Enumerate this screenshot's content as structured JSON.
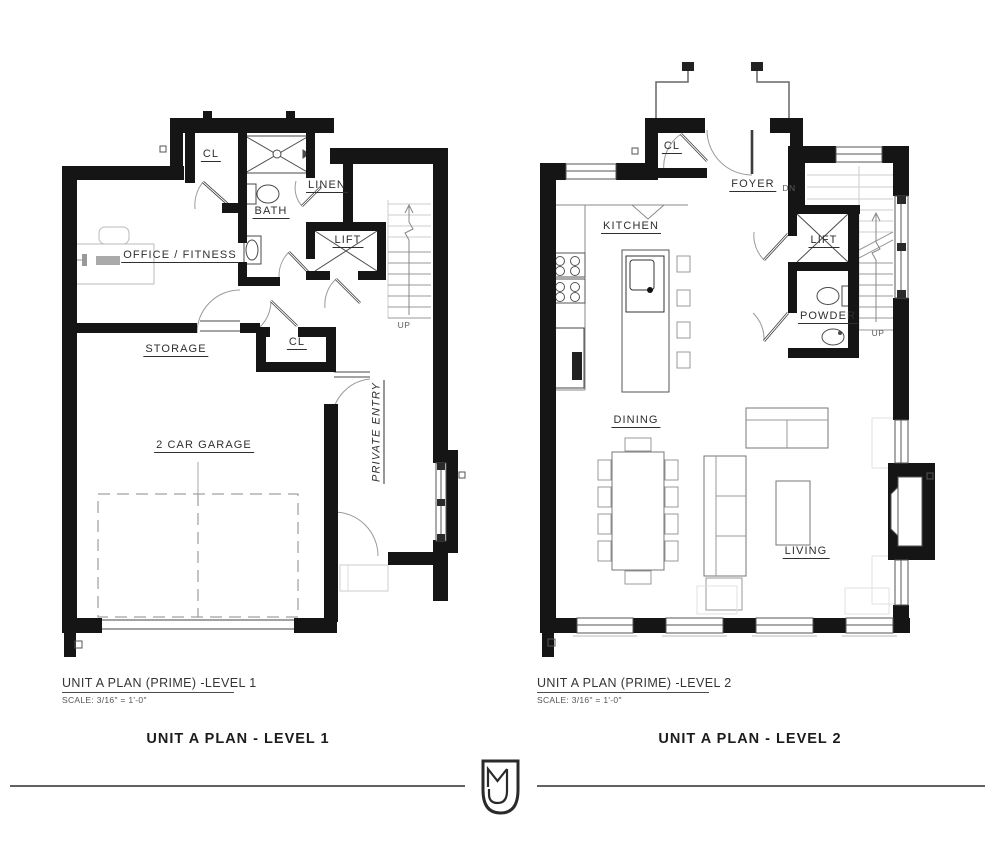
{
  "plans": {
    "level1": {
      "sheet_title": "UNIT A PLAN (PRIME) -LEVEL 1",
      "scale": "SCALE: 3/16\" = 1'-0\"",
      "caption": "UNIT A PLAN - LEVEL 1",
      "rooms": {
        "closet_top": "CL",
        "bath": "BATH",
        "linen": "LINEN",
        "lift": "LIFT",
        "office": "OFFICE / FITNESS",
        "storage": "STORAGE",
        "closet_mid": "CL",
        "garage": "2 CAR GARAGE",
        "private_entry": "PRIVATE ENTRY",
        "stairs_up": "UP"
      }
    },
    "level2": {
      "sheet_title": "UNIT A PLAN (PRIME) -LEVEL 2",
      "scale": "SCALE: 3/16\" = 1'-0\"",
      "caption": "UNIT A PLAN - LEVEL 2",
      "rooms": {
        "closet": "CL",
        "foyer": "FOYER",
        "foyer_dn": "DN",
        "kitchen": "KITCHEN",
        "lift": "LIFT",
        "powder": "POWDER",
        "stairs_up": "UP",
        "dining": "DINING",
        "living": "LIVING"
      }
    }
  },
  "footer": {
    "logo_monogram": "MJ"
  },
  "colors": {
    "wall": "#151515",
    "line": "#2f2f2f",
    "door": "#9a9a9a",
    "furniture": "#9a9a9a"
  }
}
